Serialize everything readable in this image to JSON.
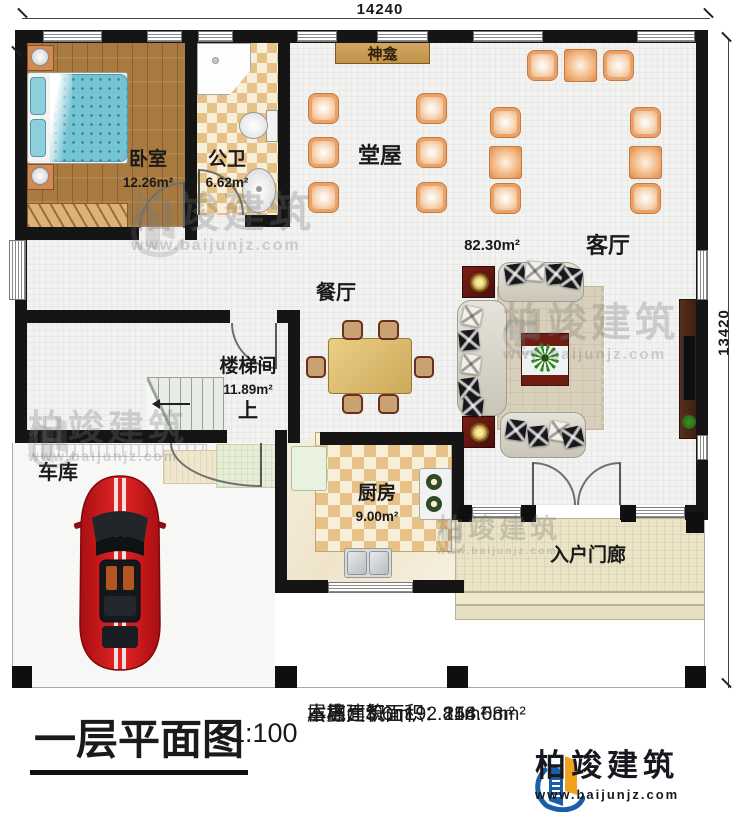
{
  "dimensions": {
    "top": "14240",
    "right": "13420"
  },
  "rooms": {
    "bedroom": {
      "label": "卧室",
      "area": "12.26m²"
    },
    "bathroom": {
      "label": "公卫",
      "area": "6.62m²"
    },
    "shrine": {
      "label": "神龛"
    },
    "hall": {
      "label": "堂屋"
    },
    "living": {
      "label": "客厅",
      "area": "82.30m²"
    },
    "dining": {
      "label": "餐厅"
    },
    "stairwell": {
      "label": "楼梯间",
      "area": "11.89m²",
      "direction": "上"
    },
    "garage": {
      "label": "车库"
    },
    "kitchen": {
      "label": "厨房",
      "area": "9.00m²"
    },
    "porch": {
      "label": "入户门廊"
    }
  },
  "watermark": {
    "name": "柏竣建筑",
    "url": "www.baijunjz.com"
  },
  "footer": {
    "title": "一层平面图",
    "scale": "1:100",
    "info": [
      {
        "label": "本层建筑面积：",
        "value": "144.08m²"
      },
      {
        "label": "本栋建筑面积：",
        "value": "258.5m²"
      },
      {
        "label": "占地面积：",
        "value": "192.81m²"
      },
      {
        "label": "层高：",
        "value": "3.6m"
      }
    ],
    "logo": {
      "name": "柏竣建筑",
      "url": "www.baijunjz.com"
    }
  },
  "colors": {
    "accent_blue": "#1b5ea8",
    "accent_orange": "#f0a11f",
    "wall": "#151515"
  }
}
